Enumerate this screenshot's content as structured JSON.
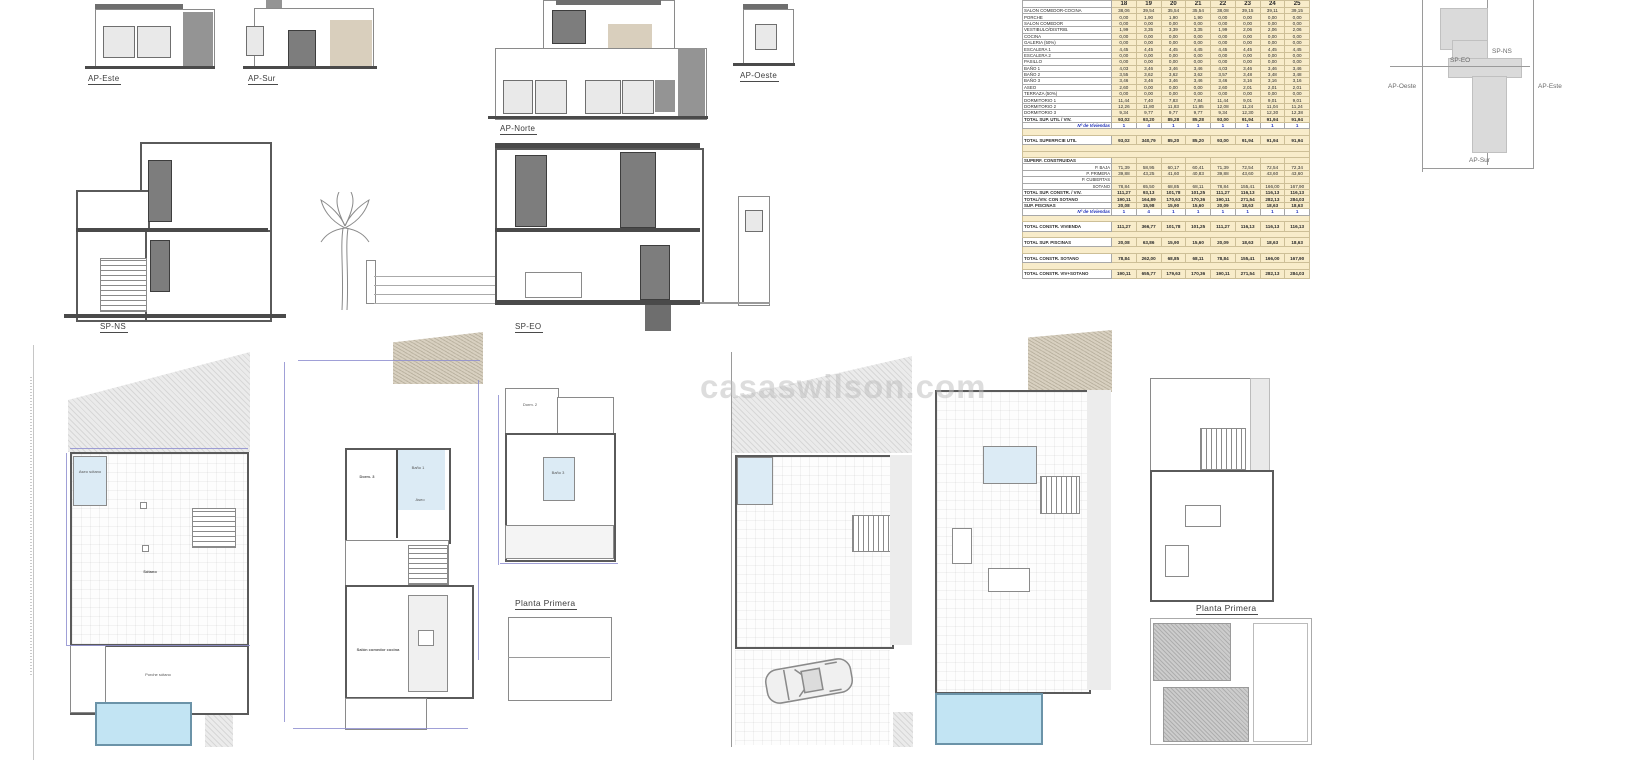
{
  "watermark": "casaswilson.com",
  "labels": {
    "ap_este": "AP-Este",
    "ap_sur": "AP-Sur",
    "ap_norte": "AP-Norte",
    "ap_oeste": "AP-Oeste",
    "sp_ns": "SP-NS",
    "sp_eo": "SP-EO",
    "planta_primera_a": "Planta Primera",
    "planta_primera_b": "Planta Primera"
  },
  "key_plan": {
    "sp_ns": "SP-NS",
    "sp_eo": "SP-EO",
    "ap_oeste": "AP-Oeste",
    "ap_este": "AP-Este",
    "ap_sur": "AP-Sur"
  },
  "rooms": {
    "sotano": "Sótano",
    "porche_sotano": "Porche sótano",
    "aseo_sotano": "Aseo sótano",
    "dorm3": "Dorm. 3",
    "bano1": "Baño 1",
    "aseo": "Aseo",
    "salon": "Salón comedor cocina",
    "dorm2": "Dorm. 2",
    "bano3": "Baño 3"
  },
  "table": {
    "colors": {
      "cell_bg": "#f8ecca",
      "accent_blue": "#2233bb"
    },
    "columns": [
      "18",
      "19",
      "20",
      "21",
      "22",
      "23",
      "24",
      "25"
    ],
    "rows": [
      {
        "label": "SALON COMEDOR-COCINA",
        "style": "n",
        "values": [
          "38,06",
          "39,54",
          "35,54",
          "35,54",
          "38,08",
          "39,15",
          "39,11",
          "39,15"
        ]
      },
      {
        "label": "PORCHE",
        "style": "n",
        "values": [
          "0,00",
          "1,90",
          "1,90",
          "1,90",
          "0,00",
          "0,00",
          "0,00",
          "0,00"
        ]
      },
      {
        "label": "SALON COMEDOR",
        "style": "n",
        "values": [
          "0,00",
          "0,00",
          "0,00",
          "0,00",
          "0,00",
          "0,00",
          "0,00",
          "0,00"
        ]
      },
      {
        "label": "VESTIBULO/DISTRIB.",
        "style": "n",
        "values": [
          "1,99",
          "3,35",
          "3,39",
          "3,35",
          "1,99",
          "2,06",
          "2,06",
          "2,06"
        ]
      },
      {
        "label": "COCINA",
        "style": "n",
        "values": [
          "0,00",
          "0,00",
          "0,00",
          "0,00",
          "0,00",
          "0,00",
          "0,00",
          "0,00"
        ]
      },
      {
        "label": "GALERIA (50%)",
        "style": "n",
        "values": [
          "0,00",
          "0,00",
          "0,00",
          "0,00",
          "0,00",
          "0,00",
          "0,00",
          "0,00"
        ]
      },
      {
        "label": "ESCALERA 1",
        "style": "n",
        "values": [
          "4,45",
          "4,45",
          "4,45",
          "4,45",
          "4,45",
          "4,45",
          "4,45",
          "4,45"
        ]
      },
      {
        "label": "ESCALERA 2",
        "style": "n",
        "values": [
          "0,00",
          "0,00",
          "0,00",
          "0,00",
          "0,00",
          "0,00",
          "0,00",
          "0,00"
        ]
      },
      {
        "label": "PASILLO",
        "style": "n",
        "values": [
          "0,00",
          "0,00",
          "0,00",
          "0,00",
          "0,00",
          "0,00",
          "0,00",
          "0,00"
        ]
      },
      {
        "label": "BAÑO 1",
        "style": "n",
        "values": [
          "4,03",
          "3,46",
          "3,46",
          "3,46",
          "4,03",
          "3,46",
          "3,46",
          "3,46"
        ]
      },
      {
        "label": "BAÑO 2",
        "style": "n",
        "values": [
          "3,55",
          "3,62",
          "3,62",
          "3,62",
          "3,57",
          "3,48",
          "3,48",
          "3,48"
        ]
      },
      {
        "label": "BAÑO 3",
        "style": "n",
        "values": [
          "3,46",
          "3,46",
          "3,46",
          "3,46",
          "3,46",
          "3,16",
          "3,16",
          "3,16"
        ]
      },
      {
        "label": "ASEO",
        "style": "n",
        "values": [
          "2,60",
          "0,00",
          "0,00",
          "0,00",
          "2,60",
          "2,01",
          "2,01",
          "2,01"
        ]
      },
      {
        "label": "TERRAZA (50%)",
        "style": "n",
        "values": [
          "0,00",
          "0,00",
          "0,00",
          "0,00",
          "0,00",
          "0,00",
          "0,00",
          "0,00"
        ]
      },
      {
        "label": "DORMITORIO 1",
        "style": "n",
        "values": [
          "11,44",
          "7,40",
          "7,83",
          "7,84",
          "11,44",
          "9,01",
          "9,01",
          "9,01"
        ]
      },
      {
        "label": "DORMITORIO 2",
        "style": "n",
        "values": [
          "12,26",
          "11,80",
          "11,83",
          "11,85",
          "12,08",
          "11,24",
          "11,04",
          "11,24"
        ]
      },
      {
        "label": "DORMITORIO 3",
        "style": "n",
        "values": [
          "9,34",
          "9,77",
          "9,77",
          "9,77",
          "9,34",
          "12,30",
          "12,30",
          "12,38"
        ]
      },
      {
        "label": "TOTAL SUP. UTIL / VIV.",
        "style": "b",
        "values": [
          "93,02",
          "93,20",
          "85,28",
          "85,28",
          "93,00",
          "91,94",
          "91,94",
          "91,94"
        ]
      },
      {
        "label": "Nº de Viviendas",
        "style": "v",
        "values": [
          "1",
          "4",
          "1",
          "1",
          "1",
          "1",
          "1",
          "1"
        ]
      },
      {
        "label": "",
        "style": "gap",
        "values": []
      },
      {
        "label": "TOTAL SUPERFICIE UTIL",
        "style": "bt",
        "values": [
          "93,02",
          "340,79",
          "85,20",
          "85,20",
          "93,00",
          "91,94",
          "91,94",
          "91,94"
        ]
      },
      {
        "label": "",
        "style": "gap",
        "values": []
      },
      {
        "label": "",
        "style": "gap",
        "values": []
      },
      {
        "label": "SUPERF. CONSTRUIDAS",
        "style": "h",
        "values": [
          "",
          "",
          "",
          "",
          "",
          "",
          "",
          ""
        ]
      },
      {
        "label": "P. BAJA",
        "style": "s",
        "values": [
          "71,39",
          "58,95",
          "60,17",
          "60,41",
          "71,39",
          "72,54",
          "72,54",
          "72,34"
        ]
      },
      {
        "label": "P. PRIMERA",
        "style": "s",
        "values": [
          "39,88",
          "43,25",
          "41,60",
          "40,83",
          "39,88",
          "43,60",
          "43,60",
          "43,60"
        ]
      },
      {
        "label": "P. CUBIERTAS",
        "style": "s",
        "values": [
          "",
          "",
          "",
          "",
          "",
          "",
          "",
          ""
        ]
      },
      {
        "label": "SOTANO",
        "style": "s",
        "values": [
          "78,84",
          "65,50",
          "68,85",
          "68,11",
          "78,84",
          "155,41",
          "166,00",
          "167,90"
        ]
      },
      {
        "label": "TOTAL SUP. CONSTR. / VIV.",
        "style": "b",
        "values": [
          "111,27",
          "93,13",
          "101,78",
          "101,25",
          "111,27",
          "116,13",
          "116,13",
          "116,13"
        ]
      },
      {
        "label": "TOTAL/VIV. CON SOTANO",
        "style": "b",
        "values": [
          "190,11",
          "164,89",
          "170,63",
          "170,36",
          "190,11",
          "271,54",
          "282,13",
          "284,03"
        ]
      },
      {
        "label": "SUP. PISCINAS",
        "style": "b",
        "values": [
          "20,08",
          "15,98",
          "15,90",
          "15,60",
          "20,09",
          "18,63",
          "18,63",
          "18,63"
        ]
      },
      {
        "label": "Nº de Viviendas",
        "style": "v",
        "values": [
          "1",
          "4",
          "1",
          "1",
          "1",
          "1",
          "1",
          "1"
        ]
      },
      {
        "label": "",
        "style": "gap",
        "values": []
      },
      {
        "label": "TOTAL CONSTR. VIVIENDA",
        "style": "bt",
        "values": [
          "111,27",
          "366,77",
          "101,78",
          "101,25",
          "111,27",
          "116,13",
          "116,13",
          "116,13"
        ]
      },
      {
        "label": "",
        "style": "gap",
        "values": []
      },
      {
        "label": "TOTAL SUP. PISCINAS",
        "style": "bt",
        "values": [
          "20,08",
          "63,86",
          "15,90",
          "15,60",
          "20,09",
          "18,63",
          "18,63",
          "18,63"
        ]
      },
      {
        "label": "",
        "style": "gap",
        "values": []
      },
      {
        "label": "TOTAL CONSTR. SOTANO",
        "style": "bt",
        "values": [
          "78,84",
          "262,00",
          "68,85",
          "68,11",
          "78,84",
          "155,41",
          "166,00",
          "167,90"
        ]
      },
      {
        "label": "",
        "style": "gap",
        "values": []
      },
      {
        "label": "TOTAL CONSTR. VIV+SOTANO",
        "style": "bt",
        "values": [
          "190,11",
          "655,77",
          "179,63",
          "170,36",
          "190,11",
          "271,54",
          "282,13",
          "284,03"
        ]
      }
    ]
  }
}
